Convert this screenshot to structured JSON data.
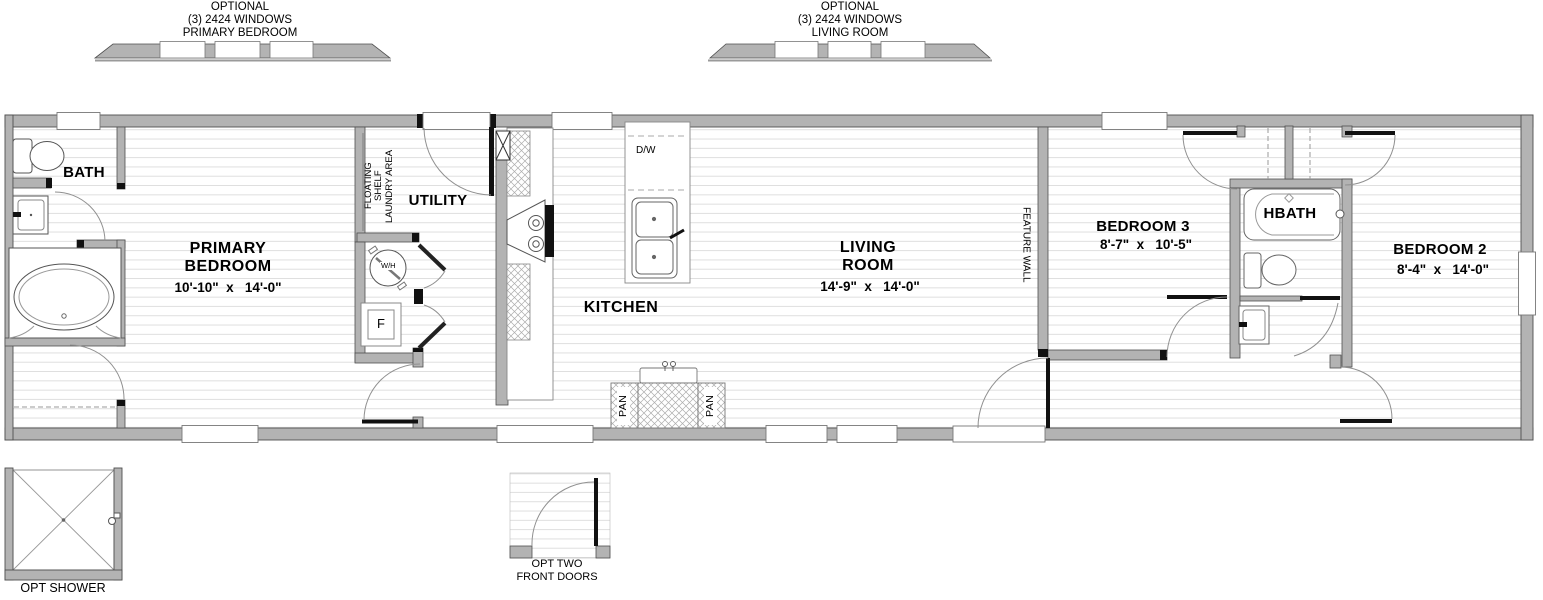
{
  "callouts": {
    "left": {
      "lines": [
        "OPTIONAL",
        "(3) 2424 WINDOWS",
        "PRIMARY BEDROOM"
      ]
    },
    "right": {
      "lines": [
        "OPTIONAL",
        "(3) 2424 WINDOWS",
        "LIVING ROOM"
      ]
    }
  },
  "rooms": {
    "bath": {
      "label": "BATH"
    },
    "primary_bedroom": {
      "line1": "PRIMARY",
      "line2": "BEDROOM",
      "dims": "10'-10\"  x   14'-0\""
    },
    "utility": {
      "label": "UTILITY"
    },
    "kitchen": {
      "label": "KITCHEN"
    },
    "living_room": {
      "line1": "LIVING",
      "line2": "ROOM",
      "dims": "14'-9\"  x   14'-0\""
    },
    "bedroom3": {
      "label": "BEDROOM 3",
      "dims": "8'-7\"  x   10'-5\""
    },
    "hbath": {
      "label": "HBATH"
    },
    "bedroom2": {
      "label": "BEDROOM 2",
      "dims": "8'-4\"  x   14'-0\""
    }
  },
  "fixtures": {
    "dishwasher": "D/W",
    "water_heater": "W/H",
    "furnace": "F",
    "pantry_left": "PAN",
    "pantry_right": "PAN"
  },
  "annotations": {
    "floating_shelf_line1": "FLOATING",
    "floating_shelf_line2": "SHELF",
    "laundry_area": "LAUNDRY AREA",
    "feature_wall": "FEATURE WALL"
  },
  "options": {
    "shower": "OPT SHOWER",
    "front_doors_line1": "OPT TWO",
    "front_doors_line2": "FRONT DOORS"
  },
  "colors": {
    "wall": "#b3b3b3",
    "wall_edge": "#4f4f4f",
    "floor_line": "#dcdcdc",
    "hatch_line": "#adadad",
    "arc": "#909090",
    "black": "#000000"
  }
}
